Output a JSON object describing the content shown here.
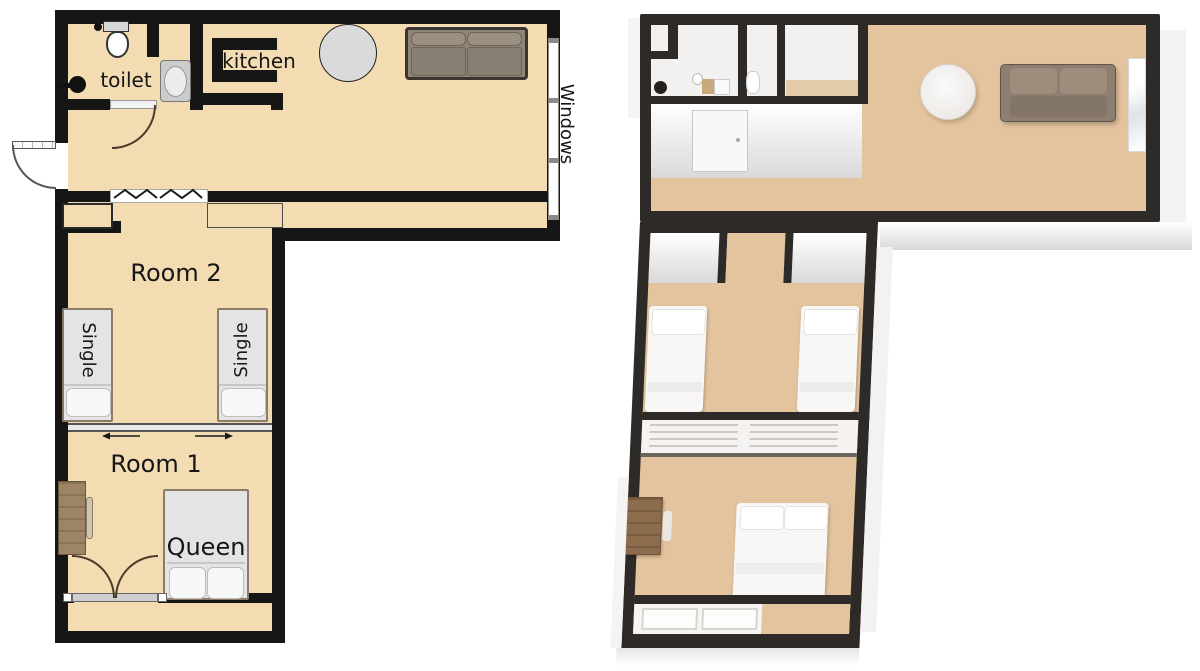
{
  "plan_2d": {
    "labels": {
      "toilet": "toilet",
      "kitchen": "kitchen",
      "windows": "Windows",
      "room2": "Room 2",
      "room1": "Room 1",
      "single_left": "Single",
      "single_right": "Single",
      "queen": "Queen"
    },
    "colors": {
      "floor": "#f3dcb2",
      "wall": "#161616",
      "bed_fill": "#e4e4e4",
      "bed_border": "#8d7b69",
      "sofa_frame": "#3a3530",
      "sofa_cushion": "#8f8577",
      "table": "#dadada",
      "desk": "#9d8465",
      "window": "#ffffff",
      "door_arc": "#4a3a28",
      "text": "#161616"
    }
  },
  "plan_3d": {
    "colors": {
      "floor": "#e4c49e",
      "wall": "#2d2a27",
      "wall_face_top": "#ffffff",
      "wall_face_bottom": "#d9d9d9",
      "sofa": "#8d7e6f",
      "bed": "#f8f7f6",
      "desk": "#8b6d4d",
      "bathroom_floor": "#f2f1ef"
    }
  }
}
